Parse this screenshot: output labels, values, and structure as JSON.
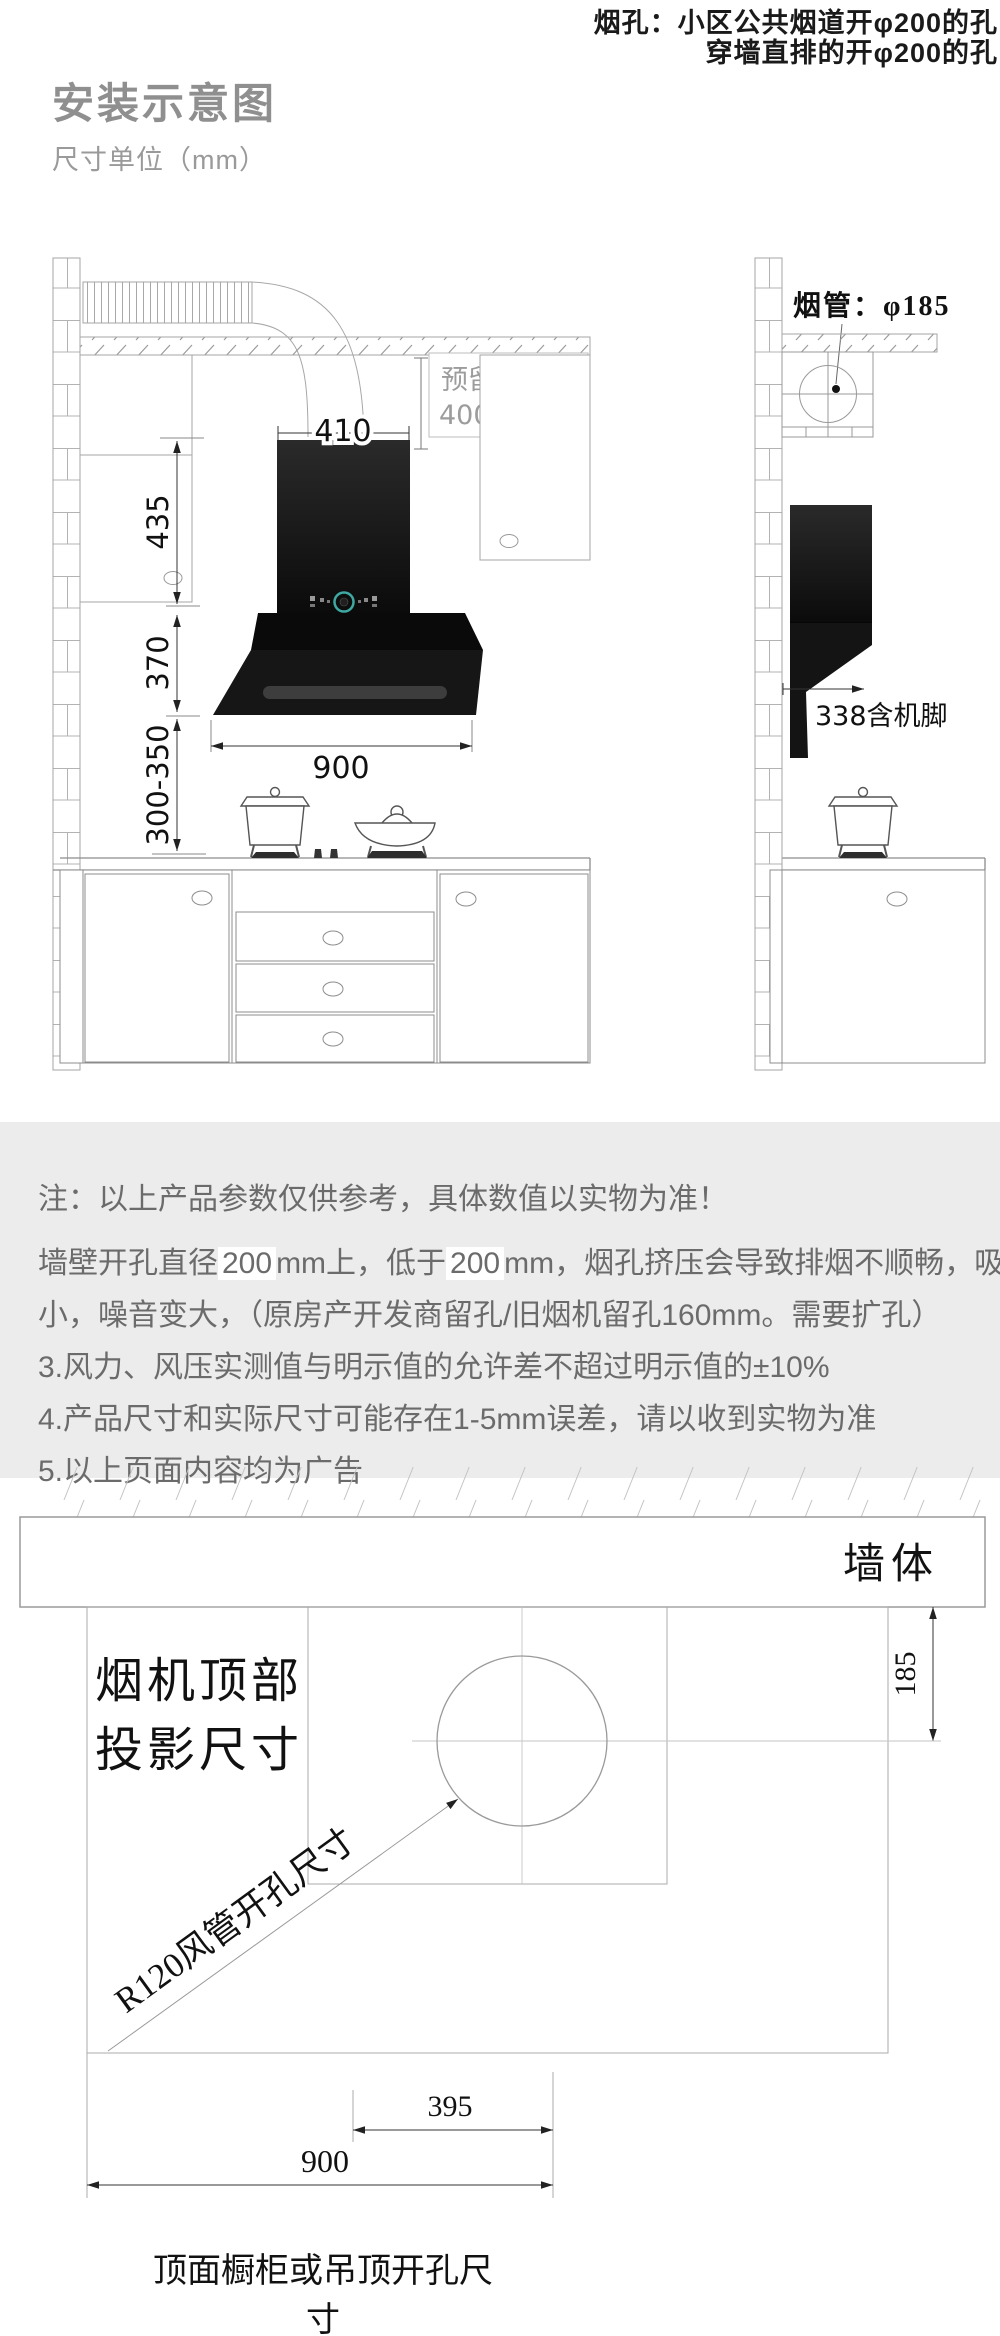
{
  "header": {
    "corner_note_line1": "烟孔：小区公共烟道开φ200的孔",
    "corner_note_line2": "穿墙直排的开φ200的孔",
    "title": "安装示意图",
    "subtitle": "尺寸单位（mm）"
  },
  "front_view": {
    "dim_chimney_width": "410",
    "dim_wall_height": "435",
    "dim_hood_height": "370",
    "dim_hood_to_counter": "300-350",
    "dim_hood_width": "900",
    "reserve_label_line1": "预留高度",
    "reserve_label_line2": "400MM"
  },
  "side_view": {
    "duct_label": "烟管：φ185",
    "depth_label": "338含机脚"
  },
  "notes": {
    "line1": "注：以上产品参数仅供参考，具体数值以实物为准！",
    "line2_parts": [
      "墙壁开孔直径",
      "200",
      "mm上，低于",
      "200",
      "mm，烟孔挤压会导致排烟不顺畅，吸力变"
    ],
    "line3": "小，噪音变大，（原房产开发商留孔/旧烟机留孔160mm。需要扩孔）",
    "line4": "3.风力、风压实测值与明示值的允许差不超过明示值的±10%",
    "line5": "4.产品尺寸和实际尺寸可能存在1-5mm误差，请以收到实物为准",
    "line6": "5.以上页面内容均为广告"
  },
  "projection": {
    "wall_label": "墙体",
    "top_label_line1": "烟机顶部",
    "top_label_line2": "投影尺寸",
    "duct_hole_label": "R120风管开孔尺寸",
    "dim_wall_offset": "185",
    "dim_right_offset": "395",
    "dim_width": "900",
    "caption": "顶面橱柜或吊顶开孔尺寸"
  },
  "colors": {
    "accent_teal": "#3fa8a1",
    "hood_black": "#141414",
    "notes_bg": "#ececec",
    "line_gray": "#a5a5a5",
    "dim_dark": "#222222",
    "title_gray": "#8f8f8f"
  }
}
